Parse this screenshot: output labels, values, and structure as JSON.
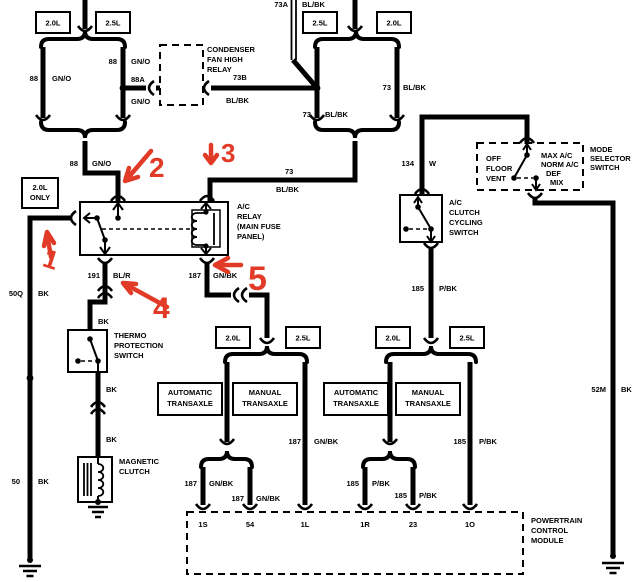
{
  "colors": {
    "wire": "#000000",
    "annotation": "#e13b28",
    "background": "#ffffff"
  },
  "engine": {
    "tl1": "2.0L",
    "tl2": "2.5L",
    "tr1": "2.5L",
    "tr2": "2.0L",
    "t1a": "2.0L",
    "t1b": "2.5L",
    "t2a": "2.0L",
    "t2b": "2.5L",
    "only1": "2.0L",
    "only2": "ONLY"
  },
  "wires": {
    "b88l": {
      "num": "88",
      "color": "GN/O"
    },
    "b88r": {
      "num": "88",
      "color": "GN/O"
    },
    "b88a": {
      "num": "88A",
      "color": "GN/O"
    },
    "f88": {
      "num": "88",
      "color": "GN/O"
    },
    "w73b": {
      "num": "73B",
      "color": "BL/BK"
    },
    "w73a": {
      "num": "73A",
      "color": "BL/BK"
    },
    "b73l": {
      "num": "73",
      "color": "BL/BK"
    },
    "b73r": {
      "num": "73",
      "color": "BL/BK"
    },
    "f73": {
      "num": "73",
      "color": "BL/BK"
    },
    "w134": {
      "num": "134",
      "color": "W"
    },
    "w52m": {
      "num": "52M",
      "color": "BK"
    },
    "w50q": {
      "num": "50Q",
      "color": "BK"
    },
    "w50": {
      "num": "50",
      "color": "BK"
    },
    "w191": {
      "num": "191",
      "color": "BL/R"
    },
    "r187": {
      "num": "187",
      "color": "GN/BK"
    },
    "m187": {
      "num": "187",
      "color": "GN/BK"
    },
    "s187a": {
      "num": "187",
      "color": "GN/BK"
    },
    "s187b": {
      "num": "187",
      "color": "GN/BK"
    },
    "c185": {
      "num": "185",
      "color": "P/BK"
    },
    "m185": {
      "num": "185",
      "color": "P/BK"
    },
    "s185a": {
      "num": "185",
      "color": "P/BK"
    },
    "s185b": {
      "num": "185",
      "color": "P/BK"
    },
    "bk1": "BK",
    "bk2": "BK",
    "bk3": "BK"
  },
  "components": {
    "condenser_relay": {
      "lines": [
        "CONDENSER",
        "FAN HIGH",
        "RELAY"
      ]
    },
    "ac_relay": {
      "lines": [
        "A/C",
        "RELAY",
        "(MAIN FUSE",
        "PANEL)"
      ]
    },
    "mode_selector": {
      "lines": [
        "MODE",
        "SELECTOR",
        "SWITCH"
      ],
      "left": [
        "OFF",
        "FLOOR",
        "VENT"
      ],
      "right": [
        "MAX A/C",
        "NORM A/C",
        "DEF",
        "MIX"
      ]
    },
    "cycling_switch": {
      "lines": [
        "A/C",
        "CLUTCH",
        "CYCLING",
        "SWITCH"
      ]
    },
    "thermo_switch": {
      "lines": [
        "THERMO",
        "PROTECTION",
        "SWITCH"
      ]
    },
    "magnetic_clutch": {
      "lines": [
        "MAGNETIC",
        "CLUTCH"
      ]
    },
    "pcm": {
      "lines": [
        "POWERTRAIN",
        "CONTROL",
        "MODULE"
      ]
    },
    "automatic_transaxle": {
      "lines": [
        "AUTOMATIC",
        "TRANSAXLE"
      ]
    },
    "manual_transaxle": {
      "lines": [
        "MANUAL",
        "TRANSAXLE"
      ]
    }
  },
  "pcm_pins": [
    "1S",
    "54",
    "1L",
    "1R",
    "23",
    "1O"
  ],
  "annotations": [
    "1",
    "2",
    "3",
    "4",
    "5"
  ]
}
